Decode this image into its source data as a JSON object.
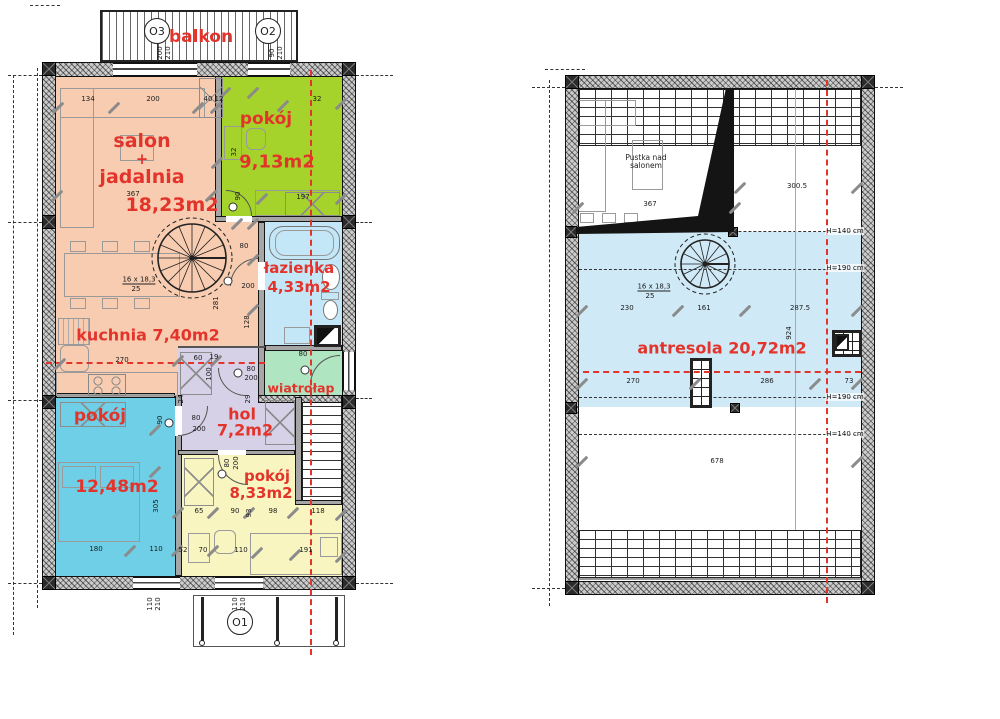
{
  "colors": {
    "red": "#e3342c",
    "salmon": "#f8ccb0",
    "green": "#a5d32b",
    "bath_blue": "#c3e7f7",
    "cyan": "#6ecfe6",
    "yellow": "#f9f5c0",
    "lavender": "#d7d1e8",
    "mint": "#b0e5c2",
    "antresola_blue": "#cfe9f7"
  },
  "left_plan": {
    "balcony_label": "balkon",
    "window_marks": {
      "o3": "O3",
      "o2": "O2",
      "o1": "O1"
    },
    "rooms": {
      "salon": {
        "l1": "salon",
        "l2": "+",
        "l3": "jadalnia",
        "area": "18,23m2"
      },
      "pokoj_top": {
        "name": "pokój",
        "area": "9,13m2"
      },
      "lazienka": {
        "name": "łazienka",
        "area": "4,33m2"
      },
      "kuchnia": {
        "name": "kuchnia 7,40m2"
      },
      "wiatrolap": {
        "name": "wiatrołap"
      },
      "hol": {
        "name": "hol",
        "area": "7,2m2"
      },
      "pokoj_left": {
        "name": "pokój",
        "area": "12,48m2"
      },
      "pokoj_bottom": {
        "name": "pokój",
        "area": "8,33m2"
      }
    },
    "dim_labels": [
      {
        "x": 88,
        "y": 99,
        "t": "134"
      },
      {
        "x": 153,
        "y": 99,
        "t": "200"
      },
      {
        "x": 208,
        "y": 99,
        "t": "40"
      },
      {
        "x": 219,
        "y": 99,
        "t": "12"
      },
      {
        "x": 317,
        "y": 99,
        "t": "32"
      },
      {
        "x": 133,
        "y": 194,
        "t": "367"
      },
      {
        "x": 303,
        "y": 197,
        "t": "197"
      },
      {
        "x": 238,
        "y": 196,
        "t": "90",
        "r": 1
      },
      {
        "x": 234,
        "y": 152,
        "t": "32",
        "r": 1
      },
      {
        "x": 244,
        "y": 246,
        "t": "80"
      },
      {
        "x": 248,
        "y": 286,
        "t": "200"
      },
      {
        "x": 216,
        "y": 303,
        "t": "281",
        "r": 1
      },
      {
        "x": 247,
        "y": 322,
        "t": "128",
        "r": 1
      },
      {
        "x": 139,
        "y": 280,
        "t": "16 x 18,3",
        "c": "u"
      },
      {
        "x": 136,
        "y": 289,
        "t": "25"
      },
      {
        "x": 122,
        "y": 360,
        "t": "270"
      },
      {
        "x": 198,
        "y": 358,
        "t": "60"
      },
      {
        "x": 214,
        "y": 357,
        "t": "19"
      },
      {
        "x": 209,
        "y": 374,
        "t": "100",
        "r": 1
      },
      {
        "x": 251,
        "y": 369,
        "t": "80"
      },
      {
        "x": 251,
        "y": 378,
        "t": "200"
      },
      {
        "x": 303,
        "y": 354,
        "t": "80"
      },
      {
        "x": 181,
        "y": 399,
        "t": "24",
        "r": 1
      },
      {
        "x": 248,
        "y": 399,
        "t": "29",
        "r": 1
      },
      {
        "x": 160,
        "y": 420,
        "t": "90",
        "r": 1
      },
      {
        "x": 196,
        "y": 418,
        "t": "80"
      },
      {
        "x": 199,
        "y": 429,
        "t": "200"
      },
      {
        "x": 227,
        "y": 463,
        "t": "80",
        "r": 1
      },
      {
        "x": 236,
        "y": 463,
        "t": "200",
        "r": 1
      },
      {
        "x": 156,
        "y": 506,
        "t": "305",
        "r": 1
      },
      {
        "x": 199,
        "y": 511,
        "t": "65"
      },
      {
        "x": 235,
        "y": 511,
        "t": "90"
      },
      {
        "x": 249,
        "y": 513,
        "t": "93",
        "r": 1
      },
      {
        "x": 273,
        "y": 511,
        "t": "98"
      },
      {
        "x": 318,
        "y": 511,
        "t": "118"
      },
      {
        "x": 96,
        "y": 549,
        "t": "180"
      },
      {
        "x": 156,
        "y": 549,
        "t": "110"
      },
      {
        "x": 183,
        "y": 550,
        "t": "52"
      },
      {
        "x": 203,
        "y": 550,
        "t": "70"
      },
      {
        "x": 241,
        "y": 550,
        "t": "110"
      },
      {
        "x": 306,
        "y": 550,
        "t": "191"
      },
      {
        "x": 160,
        "y": 53,
        "t": "200",
        "r": 1
      },
      {
        "x": 168,
        "y": 53,
        "t": "210",
        "r": 1
      },
      {
        "x": 272,
        "y": 53,
        "t": "90",
        "r": 1
      },
      {
        "x": 280,
        "y": 53,
        "t": "210",
        "r": 1
      },
      {
        "x": 150,
        "y": 604,
        "t": "110",
        "r": 1
      },
      {
        "x": 158,
        "y": 604,
        "t": "210",
        "r": 1
      },
      {
        "x": 235,
        "y": 604,
        "t": "110",
        "r": 1
      },
      {
        "x": 243,
        "y": 604,
        "t": "210",
        "r": 1
      }
    ]
  },
  "right_plan": {
    "room": {
      "name": "antresola 20,72m2"
    },
    "void_label": {
      "l1": "Pustka nad",
      "l2": "salonem"
    },
    "height_labels": [
      {
        "x": 845,
        "y": 231,
        "t": "H=140 cm"
      },
      {
        "x": 845,
        "y": 268,
        "t": "H=190 cm"
      },
      {
        "x": 845,
        "y": 397,
        "t": "H=190 cm"
      },
      {
        "x": 845,
        "y": 434,
        "t": "H=140 cm"
      }
    ],
    "dim_labels": [
      {
        "x": 650,
        "y": 204,
        "t": "367"
      },
      {
        "x": 797,
        "y": 186,
        "t": "300.5"
      },
      {
        "x": 627,
        "y": 308,
        "t": "230"
      },
      {
        "x": 704,
        "y": 308,
        "t": "161"
      },
      {
        "x": 800,
        "y": 308,
        "t": "287.5"
      },
      {
        "x": 789,
        "y": 333,
        "t": "924",
        "r": 1
      },
      {
        "x": 633,
        "y": 381,
        "t": "270"
      },
      {
        "x": 767,
        "y": 381,
        "t": "286"
      },
      {
        "x": 849,
        "y": 381,
        "t": "73"
      },
      {
        "x": 717,
        "y": 461,
        "t": "678"
      },
      {
        "x": 654,
        "y": 287,
        "t": "16 x 18,3",
        "c": "u"
      },
      {
        "x": 650,
        "y": 296,
        "t": "25"
      }
    ]
  },
  "decor": {
    "slashes": [
      [
        58,
        108
      ],
      [
        114,
        108
      ],
      [
        198,
        108
      ],
      [
        216,
        108
      ],
      [
        283,
        106
      ],
      [
        341,
        104
      ],
      [
        57,
        196
      ],
      [
        211,
        196
      ],
      [
        262,
        199
      ],
      [
        341,
        199
      ],
      [
        217,
        163
      ],
      [
        60,
        364
      ],
      [
        178,
        361
      ],
      [
        216,
        361
      ],
      [
        237,
        224
      ],
      [
        253,
        224
      ],
      [
        178,
        513
      ],
      [
        213,
        513
      ],
      [
        249,
        513
      ],
      [
        293,
        513
      ],
      [
        341,
        515
      ],
      [
        130,
        551
      ],
      [
        177,
        551
      ],
      [
        213,
        551
      ],
      [
        257,
        553
      ],
      [
        295,
        555
      ],
      [
        341,
        557
      ],
      [
        155,
        472
      ],
      [
        155,
        430
      ],
      [
        253,
        310
      ],
      [
        253,
        260
      ],
      [
        225,
        93
      ],
      [
        253,
        93
      ],
      [
        578,
        208
      ],
      [
        735,
        208
      ],
      [
        740,
        188
      ],
      [
        857,
        188
      ],
      [
        582,
        311
      ],
      [
        678,
        311
      ],
      [
        745,
        311
      ],
      [
        857,
        311
      ],
      [
        582,
        384
      ],
      [
        695,
        384
      ],
      [
        815,
        384
      ],
      [
        857,
        384
      ],
      [
        582,
        462
      ],
      [
        857,
        462
      ]
    ],
    "door_marks": [
      [
        228,
        281
      ],
      [
        233,
        207
      ],
      [
        169,
        423
      ],
      [
        238,
        373
      ],
      [
        222,
        474
      ],
      [
        305,
        370
      ]
    ]
  }
}
